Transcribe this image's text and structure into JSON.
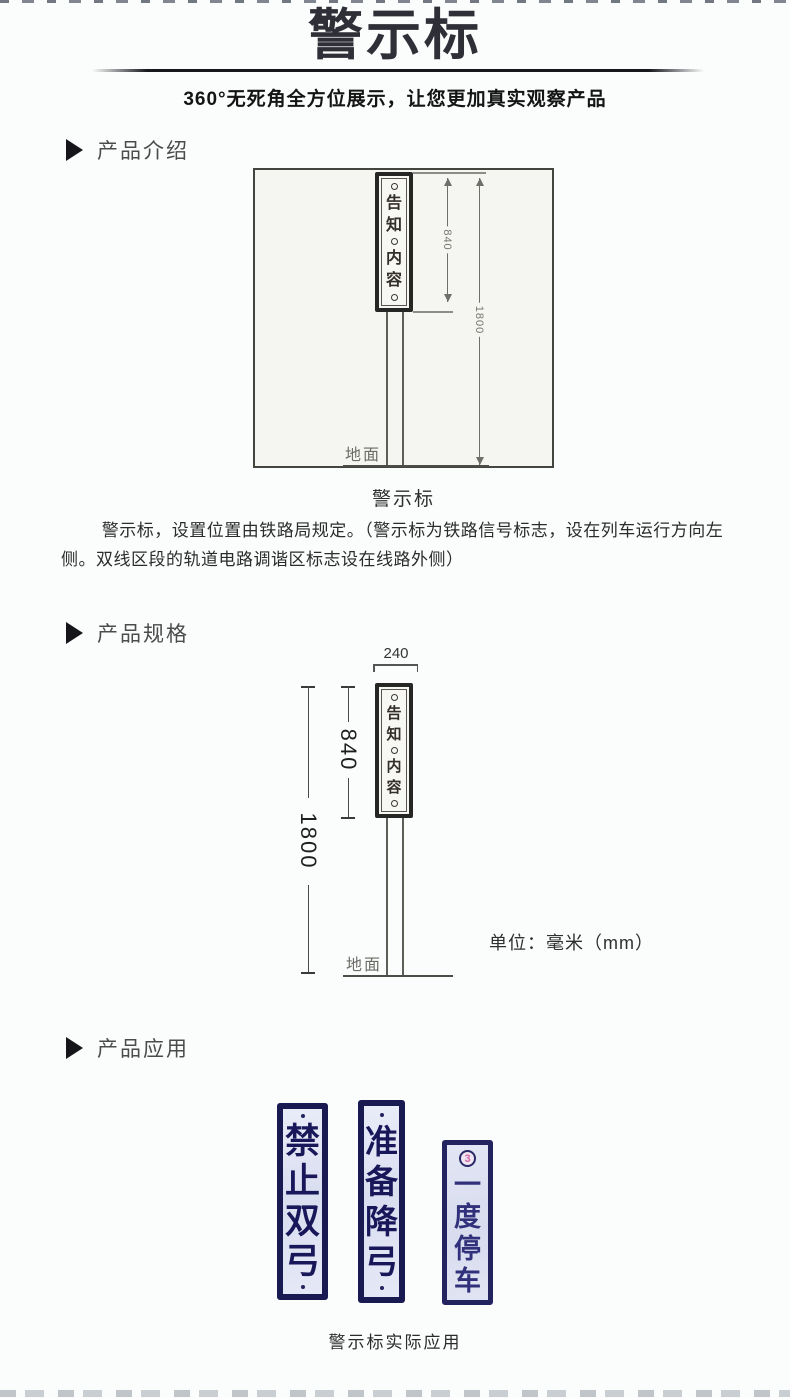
{
  "header": {
    "title": "警示标",
    "subtitle": "360°无死角全方位展示，让您更加真实观察产品"
  },
  "sections": {
    "intro": {
      "label": "产品介绍",
      "drawing": {
        "sign_chars": [
          "告",
          "知",
          "内",
          "容"
        ],
        "dim_sign_height": "840",
        "dim_total_height": "1800",
        "ground_label": "地面"
      },
      "caption": "警示标",
      "paragraph": "警示标，设置位置由铁路局规定。（警示标为铁路信号标志，设在列车运行方向左侧。双线区段的轨道电路调谐区标志设在线路外侧）"
    },
    "specs": {
      "label": "产品规格",
      "drawing": {
        "dim_width": "240",
        "sign_chars": [
          "告",
          "知",
          "内",
          "容"
        ],
        "dim_sign_height": "840",
        "dim_total_height": "1800",
        "ground_label": "地面"
      },
      "unit_note": "单位：毫米（mm）"
    },
    "application": {
      "label": "产品应用",
      "signs": [
        {
          "chars": [
            "禁",
            "止",
            "双",
            "弓"
          ]
        },
        {
          "chars": [
            "准",
            "备",
            "降",
            "弓"
          ]
        },
        {
          "badge": "3",
          "chars": [
            "一",
            "度",
            "停",
            "车"
          ]
        }
      ],
      "caption": "警示标实际应用"
    }
  },
  "colors": {
    "page_background": "#fbfdfd",
    "title_ink": "#2e2f37",
    "drawing_paper": "#f5f6f2",
    "sign_navy": "#1a1a52",
    "sign_face": "#dde2f2",
    "badge_pink": "#ce68a6"
  }
}
